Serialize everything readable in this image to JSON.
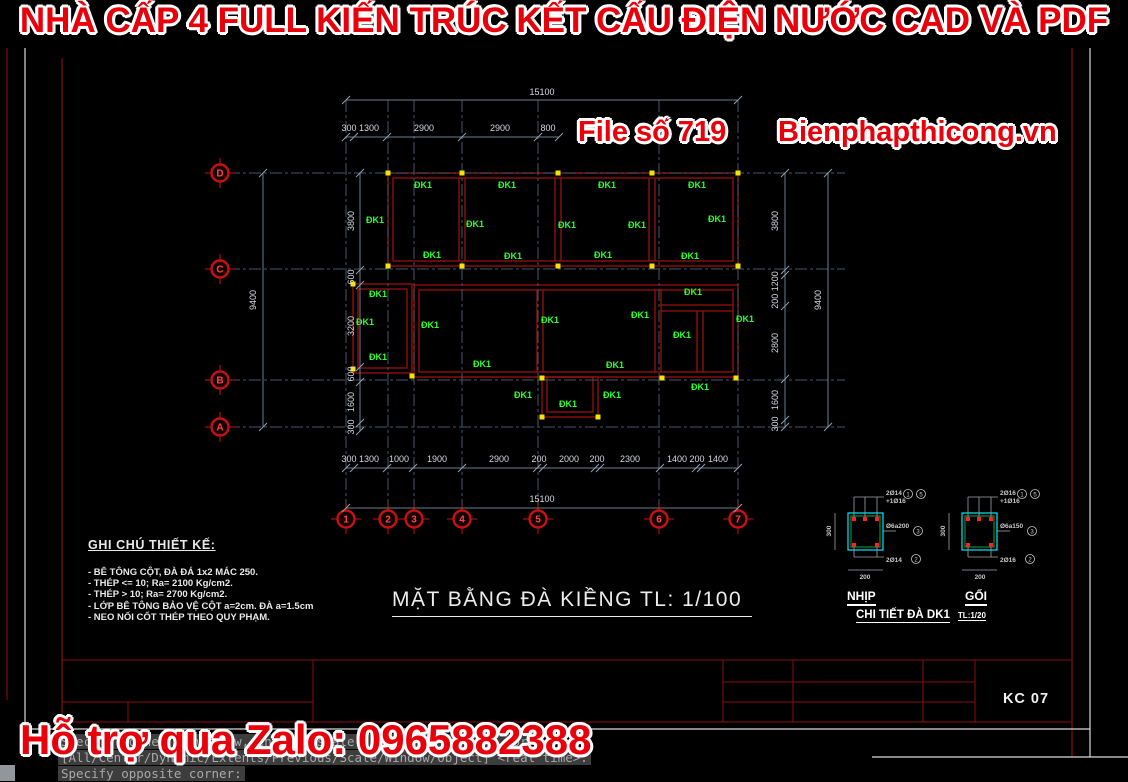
{
  "window": {
    "top_banner": "NHÀ CẤP 4 FULL KIẾN TRÚC KẾT CẤU ĐIỆN NƯỚC CAD VÀ PDF",
    "watermark_file": "File số 719",
    "watermark_site": "Bienphapthicong.vn",
    "bottom_banner": "Hỗ trợ qua Zalo: 0965882388"
  },
  "plan": {
    "title": "MẶT BẰNG ĐÀ KIỀNG  TL: 1/100",
    "beam_label": "ĐK1",
    "grid_rows": [
      "D",
      "C",
      "B",
      "A"
    ],
    "grid_cols": [
      "1",
      "2",
      "3",
      "4",
      "5",
      "6",
      "7"
    ],
    "dims_top": {
      "overall": "15100",
      "segments": [
        "300",
        "1300",
        "2900",
        "2900",
        "800"
      ]
    },
    "dims_bottom": {
      "overall": "15100",
      "segments": [
        "300",
        "1300",
        "1000",
        "1900",
        "2900",
        "200",
        "2000",
        "200",
        "2300",
        "1400",
        "200",
        "1400"
      ]
    },
    "dims_left": {
      "overall": "9400",
      "segments": [
        "3800",
        "600",
        "3200",
        "600",
        "1600",
        "300"
      ]
    },
    "dims_right": {
      "overall": "9400",
      "segments": [
        "3800",
        "200 1200",
        "2800",
        "1600",
        "300"
      ]
    }
  },
  "notes": {
    "title": "GHI CHÚ THIẾT KẾ:",
    "items": [
      "- BÊ TÔNG  CỘT, ĐÀ  ĐÁ 1x2 MÁC 250.",
      "- THÉP <= 10; Ra= 2100 Kg/cm2.",
      "- THÉP > 10; Ra= 2700 Kg/cm2.",
      "- LỚP BÊ TÔNG BẢO VỆ CỘT a=2cm. ĐÀ a=1.5cm",
      "- NEO NỐI CỐT THÉP THEO QUY PHẠM."
    ]
  },
  "details": {
    "title": "CHI TIẾT ĐÀ  DK1",
    "scale": "TL:1/20",
    "sections": [
      {
        "name": "NHỊP",
        "top_rebar": "2Ø14",
        "top_extra": "+1Ø16",
        "stirrup": "Ø6a200",
        "bottom_rebar": "2Ø14",
        "width_dim": "200",
        "height_dim": "300",
        "callout_top_1": "1",
        "callout_top_2": "5",
        "callout_mid": "3",
        "callout_bottom": "2"
      },
      {
        "name": "GỐI",
        "top_rebar": "2Ø16",
        "top_extra": "+1Ø16",
        "stirrup": "Ø6a150",
        "bottom_rebar": "2Ø16",
        "width_dim": "200",
        "height_dim": "300",
        "callout_top_1": "1",
        "callout_top_2": "5",
        "callout_mid": "3",
        "callout_bottom": "2"
      }
    ]
  },
  "title_block": {
    "sheet_no": "KC 07"
  },
  "command_line": {
    "lines": [
      "Specify corner of window, enter a scale factor (nX or nXP), or",
      "[All/Center/Dynamic/Extents/Previous/Scale/Window/Object] <real time>:",
      "Specify opposite corner:"
    ]
  },
  "colors": {
    "background": "#000000",
    "banner_red": "#e8000b",
    "cad_beam_red": "#9b1010",
    "grid_blue": "#44566e",
    "dim_text": "#d4dae0",
    "beam_label_green": "#2bff2b",
    "node_yellow": "#f5e400",
    "detail_cyan": "#00e5ff",
    "detail_green": "#00aa44",
    "rebar_red": "#ff2020"
  }
}
